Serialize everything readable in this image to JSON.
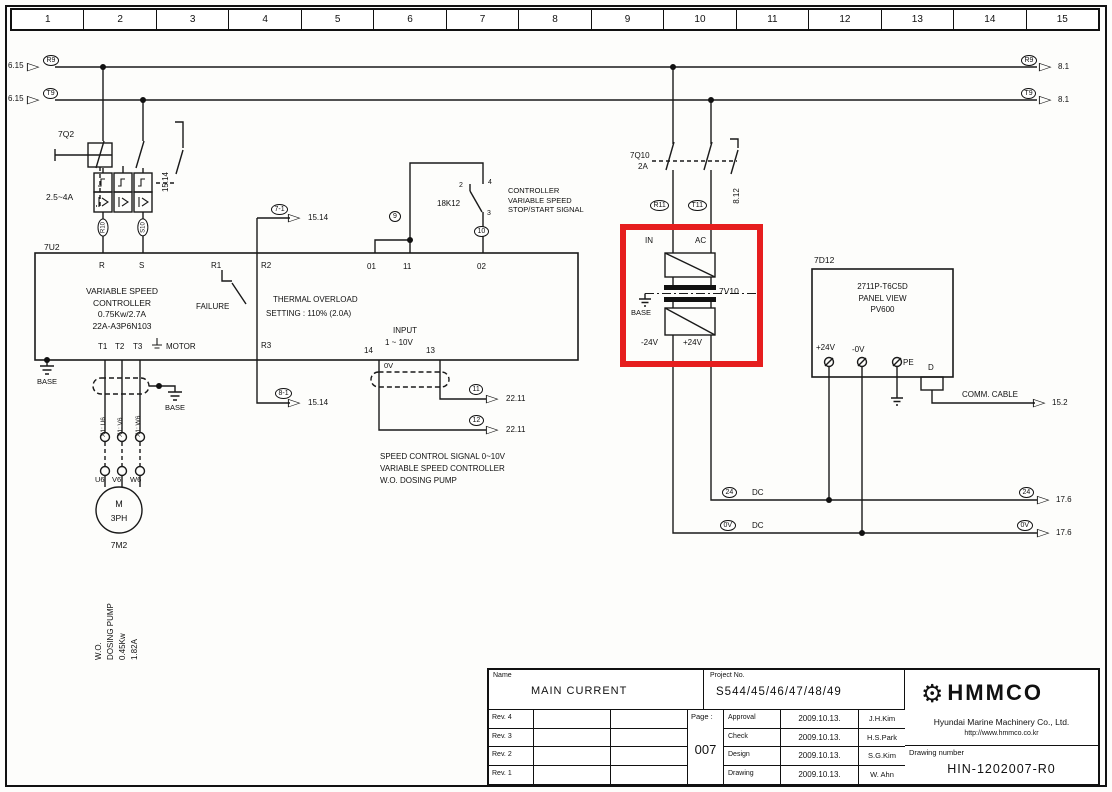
{
  "icons": {
    "ref_arrow": "▷",
    "gear": "⚙"
  },
  "ruler": {
    "cols": [
      "1",
      "2",
      "3",
      "4",
      "5",
      "6",
      "7",
      "8",
      "9",
      "10",
      "11",
      "12",
      "13",
      "14",
      "15"
    ]
  },
  "rails": {
    "top_left_ref": "6.15",
    "top_wire": "R9",
    "top_right_ref": "8.1",
    "bot_left_ref": "6.15",
    "bot_wire": "T9",
    "bot_right_ref": "8.1"
  },
  "q2": {
    "label": "7Q2",
    "rating": "2.5~4A",
    "aux_ref": "15.14",
    "wire_a": "R10",
    "wire_b": "S10"
  },
  "u2": {
    "label": "7U2",
    "name1": "VARIABLE SPEED",
    "name2": "CONTROLLER",
    "name3": "0.75Kw/2.7A",
    "name4": "22A-A3P6N103",
    "t_r": "R",
    "t_s": "S",
    "t_r1": "R1",
    "t_r2": "R2",
    "t_r3": "R3",
    "t_01": "01",
    "t_11": "11",
    "t_02": "02",
    "t_14": "14",
    "t_13": "13",
    "t_t1": "T1",
    "t_t2": "T2",
    "t_t3": "T3",
    "motor": "MOTOR",
    "failure": "FAILURE",
    "thermal1": "THERMAL OVERLOAD",
    "thermal2": "SETTING : 110% (2.0A)",
    "input1": "INPUT",
    "input2": "1 ~ 10V",
    "base": "BASE"
  },
  "refs": {
    "r2_bubble": "7-1",
    "r2_ref": "15.14",
    "r3_bubble": "8-1",
    "r3_ref": "15.14",
    "w9": "9",
    "w10": "10",
    "sig11": "11",
    "sig11_ref": "22.11",
    "sig12": "12",
    "sig12_ref": "22.11"
  },
  "k12": {
    "label": "18K12",
    "c2": "2",
    "c4": "4",
    "c3": "3",
    "note1": "CONTROLLER",
    "note2": "VARIABLE SPEED",
    "note3": "STOP/START SIGNAL"
  },
  "shield": {
    "ov": "0V",
    "base": "BASE"
  },
  "note": {
    "l1": "SPEED CONTROL SIGNAL 0~10V",
    "l2": "VARIABLE SPEED CONTROLLER",
    "l3": "W.O. DOSING PUMP"
  },
  "motor": {
    "x1u": "X1: U6",
    "x1v": "X1: V6",
    "x1w": "X1: W6",
    "u6": "U6",
    "v6": "V6",
    "w6": "W6",
    "m": "M",
    "ph": "3PH",
    "tag": "7M2",
    "r1": "W.O.",
    "r2": "DOSING PUMP",
    "r3": "0.45Kw",
    "r4": "1.82A"
  },
  "q10": {
    "label": "7Q10",
    "rating": "2A",
    "aux_ref": "8.12",
    "wire_a": "R11",
    "wire_b": "T11"
  },
  "psu": {
    "in": "IN",
    "ac": "AC",
    "tag": "7V10",
    "base": "BASE",
    "neg": "-24V",
    "pos": "+24V"
  },
  "panel": {
    "tag": "7D12",
    "m1": "2711P-T6C5D",
    "m2": "PANEL VIEW",
    "m3": "PV600",
    "p24": "+24V",
    "n0": "-0V",
    "pe": "PE",
    "d": "D",
    "comm": "COMM. CABLE",
    "comm_ref": "15.2"
  },
  "dc": {
    "pos_wire": "24",
    "pos_label": "DC",
    "pos_ref": "17.6",
    "neg_wire": "0V",
    "neg_label": "DC",
    "neg_ref": "17.6"
  },
  "titleblock": {
    "name_label": "Name",
    "name": "MAIN CURRENT",
    "project_label": "Project No.",
    "project": "S544/45/46/47/48/49",
    "revs": [
      "Rev. 4",
      "Rev. 3",
      "Rev. 2",
      "Rev. 1"
    ],
    "page_label": "Page :",
    "page": "007",
    "approvals": [
      {
        "role": "Approval",
        "date": "2009.10.13.",
        "name": "J.H.Kim"
      },
      {
        "role": "Check",
        "date": "2009.10.13.",
        "name": "H.S.Park"
      },
      {
        "role": "Design",
        "date": "2009.10.13.",
        "name": "S.G.Kim"
      },
      {
        "role": "Drawing",
        "date": "2009.10.13.",
        "name": "W. Ahn"
      }
    ],
    "company": "HMMCO",
    "company_full": "Hyundai Marine Machinery Co., Ltd.",
    "url": "http://www.hmmco.co.kr",
    "drawing_number_label": "Drawing number",
    "drawing_number": "HIN-1202007-R0"
  },
  "colors": {
    "highlight": "#e61e1e",
    "ink": "#1a1a1a"
  }
}
